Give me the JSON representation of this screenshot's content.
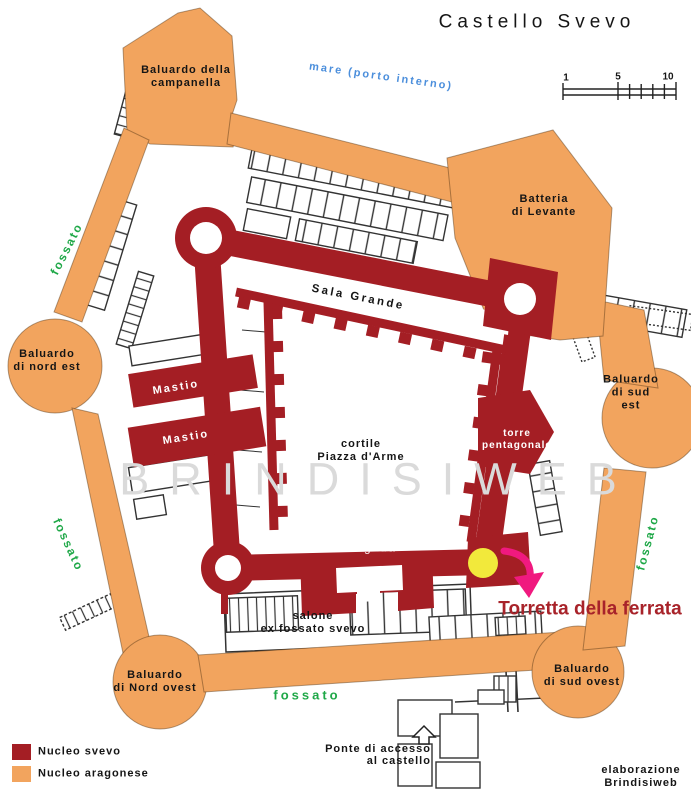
{
  "map": {
    "title": "Castello Svevo",
    "sea": "mare (porto interno)",
    "watermark": "BRINDISIWEB",
    "labels": {
      "campanella": "Baluardo della\ncampanella",
      "batteria": "Batteria\ndi Levante",
      "nord_est": "Baluardo\ndi nord est",
      "sud_est": "Baluardo\ndi sud est",
      "nord_ovest": "Baluardo\ndi Nord ovest",
      "sud_ovest": "Baluardo\ndi sud ovest",
      "sala_grande": "Sala Grande",
      "mastio": "Mastio",
      "cortile": "cortile\nPiazza d'Arme",
      "torre_pentagonale": "torre\npentagonale",
      "torre_magistra": "Torre Magistra",
      "salone": "salone\nex fossato svevo",
      "fossato": "fossato",
      "ponte": "Ponte di accesso\nal castello",
      "torretta": "Torretta della ferrata"
    },
    "scale_bar": {
      "t1": "1",
      "t5": "5",
      "t10": "10"
    },
    "legend": {
      "svevo": "Nucleo svevo",
      "aragonese": "Nucleo aragonese"
    },
    "credit": "elaborazione\nBrindisiweb",
    "colors": {
      "nucleo_svevo": "#A41E24",
      "nucleo_aragonese": "#F2A45E",
      "fossato_text": "#1FA848",
      "mare_text": "#4C8FDC",
      "marker_yellow": "#F2E93B",
      "arrow_pink": "#F0197F",
      "torretta_text": "#A8232A",
      "plan_lines": "#333333",
      "watermark": "#DADADA"
    }
  }
}
